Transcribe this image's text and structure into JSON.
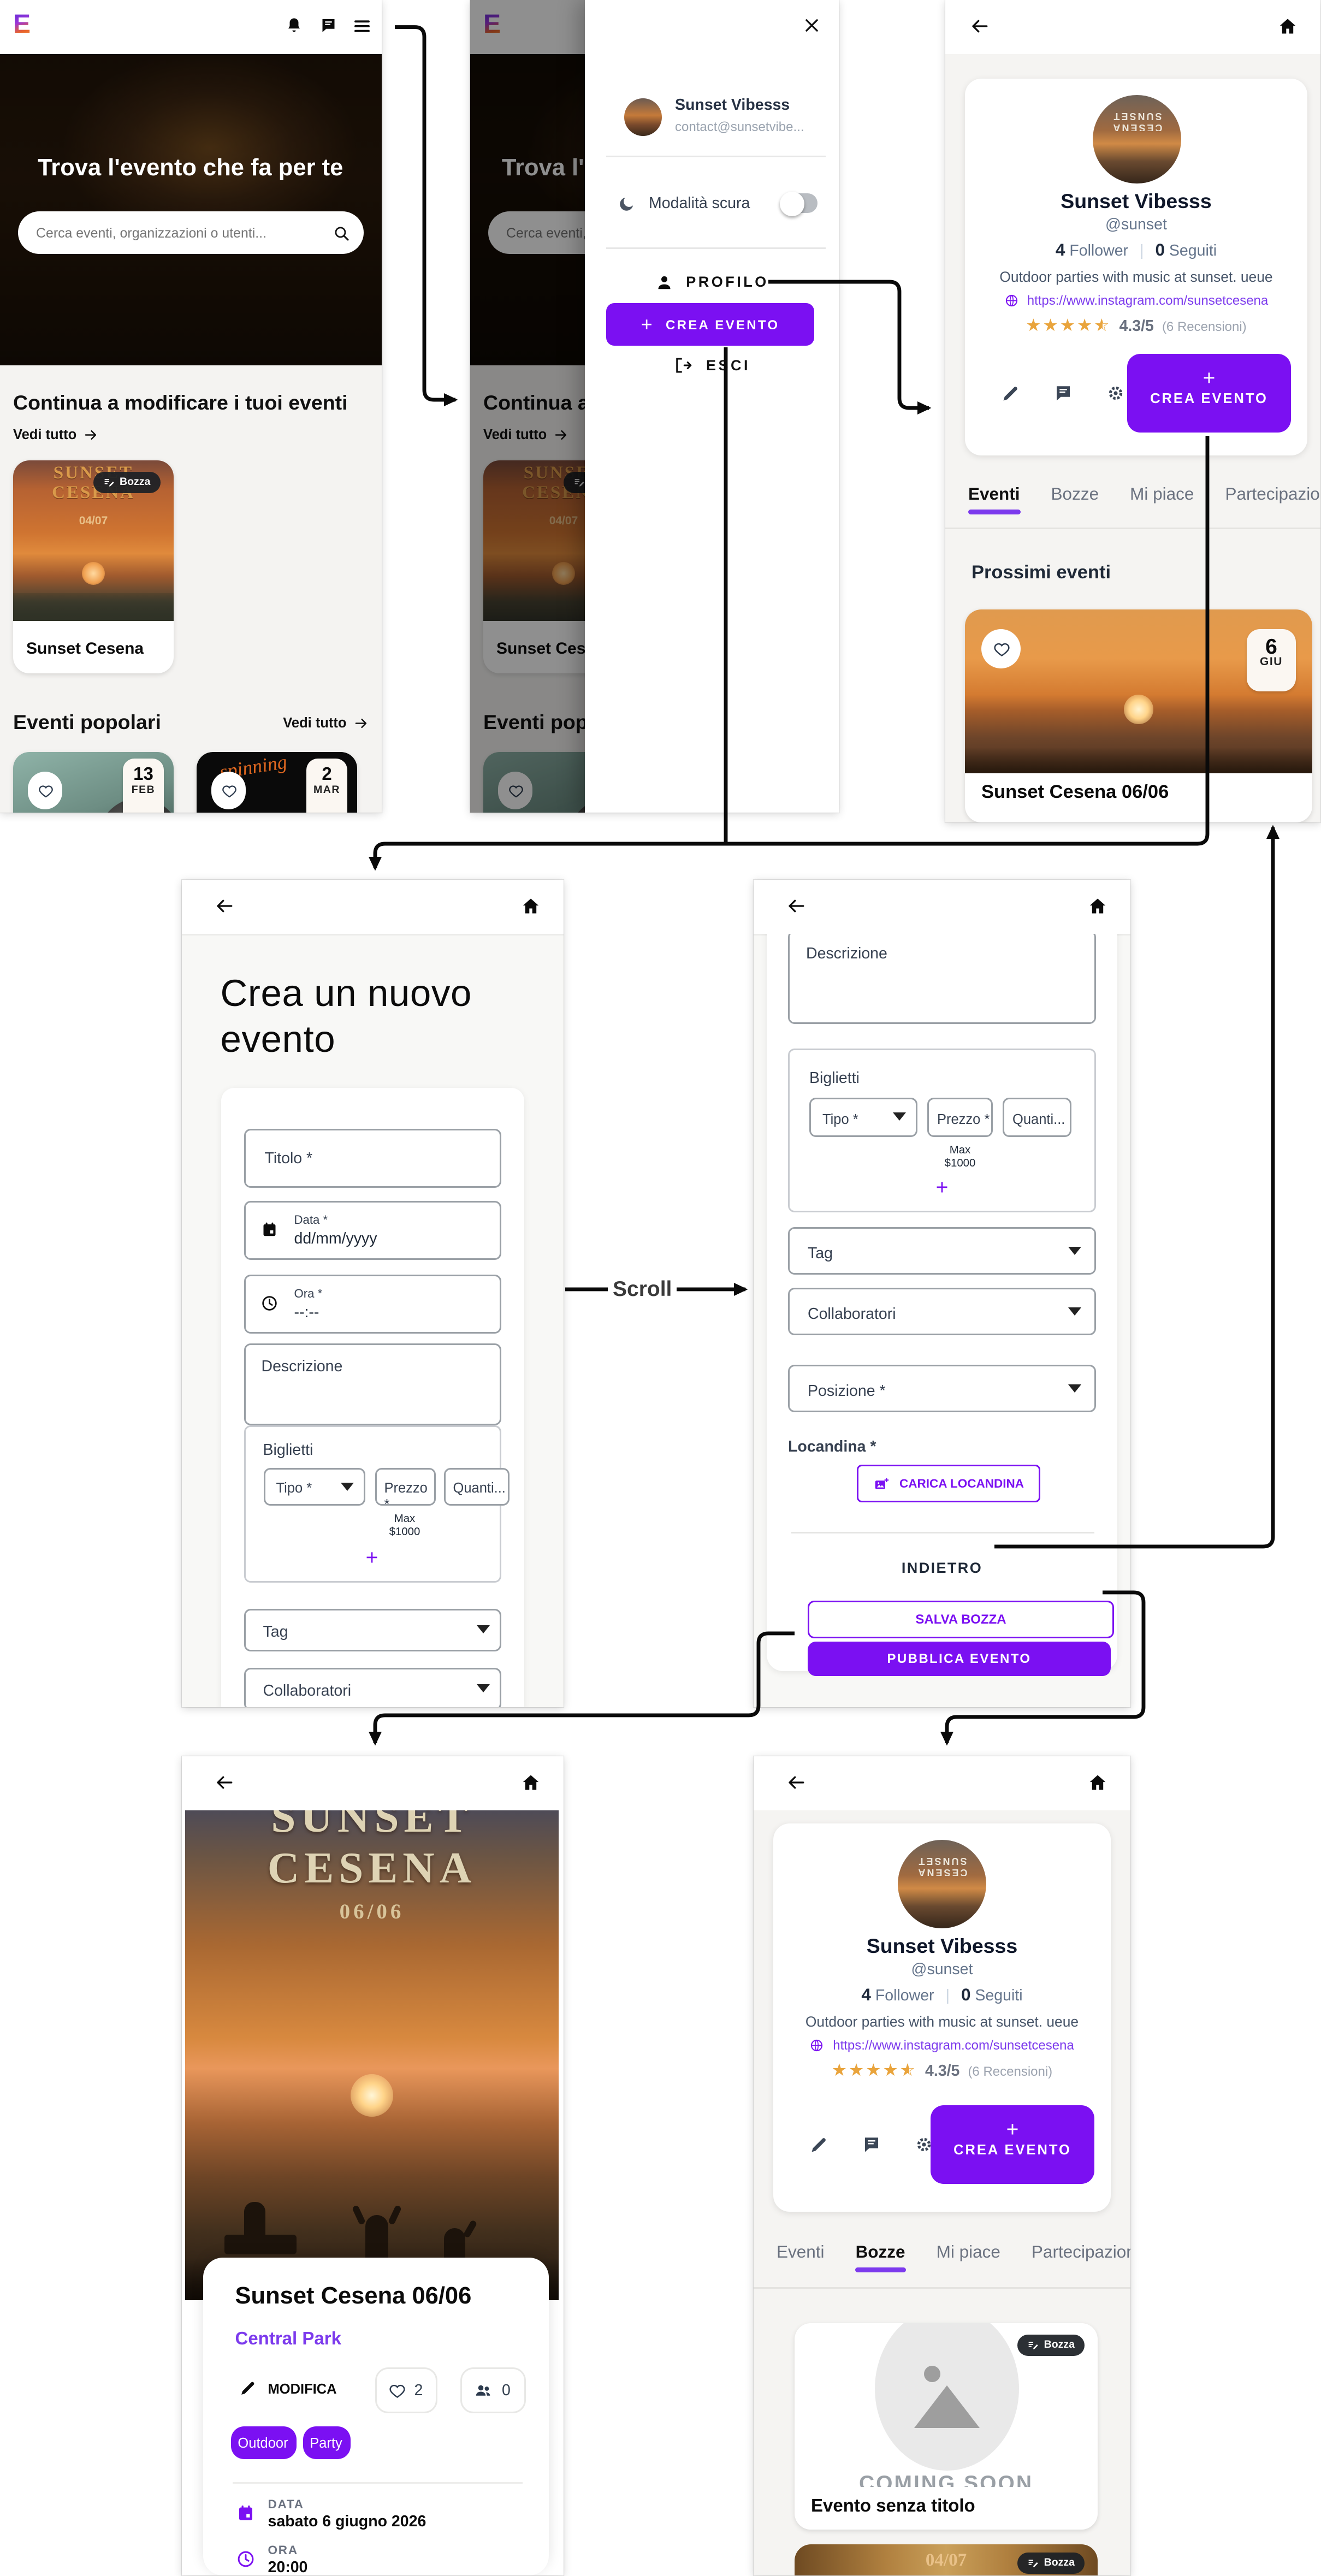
{
  "colors": {
    "accent": "#7b10f2",
    "link": "#7c3aed",
    "star": "#e9a43c",
    "badge_bg": "#1c2026"
  },
  "icons": {
    "notifications": "bell",
    "messages": "chat-bubble",
    "menu": "hamburger",
    "close": "x",
    "back": "arrow-left",
    "home": "house",
    "search": "magnifier",
    "dark_mode": "moon",
    "profile": "person",
    "logout": "door-arrow",
    "edit": "pencil",
    "settings": "gear",
    "like": "heart",
    "attendees": "two-people",
    "date": "calendar",
    "time": "clock",
    "website": "globe",
    "upload": "image-plus",
    "draft": "edit-note",
    "expand": "caret-down"
  },
  "common": {
    "bozza": "Bozza",
    "see_all": "Vedi tutto",
    "scroll_label": "Scroll"
  },
  "home": {
    "hero_title": "Trova l'evento che fa per te",
    "search_placeholder": "Cerca eventi, organizzazioni o utenti...",
    "continue_heading": "Continua a modificare i tuoi eventi",
    "popular_heading": "Eventi popolari",
    "draft_card": {
      "poster_line1": "SUNSET",
      "poster_line2": "CESENA",
      "poster_date": "04/07",
      "title": "Sunset Cesena"
    },
    "popular_cards": [
      {
        "day": "13",
        "month": "FEB",
        "art": "microphone-photo"
      },
      {
        "day": "2",
        "month": "MAR",
        "art_text": "spinning"
      }
    ]
  },
  "drawer": {
    "name": "Sunset Vibesss",
    "email": "contact@sunsetvibe...",
    "dark_mode_label": "Modalità scura",
    "profile_label": "PROFILO",
    "create_event_label": "CREA EVENTO",
    "logout_label": "ESCI"
  },
  "profile": {
    "name": "Sunset Vibesss",
    "handle": "@sunset",
    "followers_count": "4",
    "followers_label": "Follower",
    "following_count": "0",
    "following_label": "Seguiti",
    "bio": "Outdoor parties with music at sunset. ueue",
    "website": "https://www.instagram.com/sunsetcesena",
    "rating": "4.3/5",
    "reviews_label": "(6 Recensioni)",
    "create_event_label": "CREA EVENTO",
    "tabs": [
      {
        "label": "Eventi"
      },
      {
        "label": "Bozze"
      },
      {
        "label": "Mi piace"
      },
      {
        "label": "Partecipazior"
      }
    ],
    "upcoming_heading": "Prossimi eventi",
    "upcoming_event": {
      "title": "Sunset Cesena 06/06",
      "day": "6",
      "month": "GIU"
    },
    "drafts": [
      {
        "title": "Evento senza titolo",
        "placeholder_text": "COMING SOON"
      },
      {
        "poster_date": "04/07"
      }
    ]
  },
  "create_event": {
    "page_title": "Crea un nuovo evento",
    "titolo_label": "Titolo *",
    "data_label": "Data *",
    "data_value": "dd/mm/yyyy",
    "ora_label": "Ora *",
    "ora_value": "--:--",
    "descrizione_label": "Descrizione",
    "biglietti_label": "Biglietti",
    "tipo_label": "Tipo *",
    "prezzo_label": "Prezzo *",
    "quantita_label": "Quanti...",
    "max_line1": "Max",
    "max_line2": "$1000",
    "add_ticket": "+",
    "tag_label": "Tag",
    "collaboratori_label": "Collaboratori",
    "posizione_label": "Posizione *",
    "locandina_label": "Locandina *",
    "carica_label": "CARICA LOCANDINA",
    "indietro_label": "INDIETRO",
    "salva_label": "SALVA BOZZA",
    "pubblica_label": "PUBBLICA EVENTO"
  },
  "event_detail": {
    "poster_line1": "SUNSET",
    "poster_line2": "CESENA",
    "poster_date": "06/06",
    "title": "Sunset Cesena 06/06",
    "location": "Central Park",
    "modifica_label": "MODIFICA",
    "likes_count": "2",
    "attendees_count": "0",
    "tags": [
      {
        "label": "Outdoor"
      },
      {
        "label": "Party"
      }
    ],
    "data_label": "DATA",
    "data_value": "sabato 6 giugno 2026",
    "ora_label": "ORA",
    "ora_value": "20:00"
  }
}
